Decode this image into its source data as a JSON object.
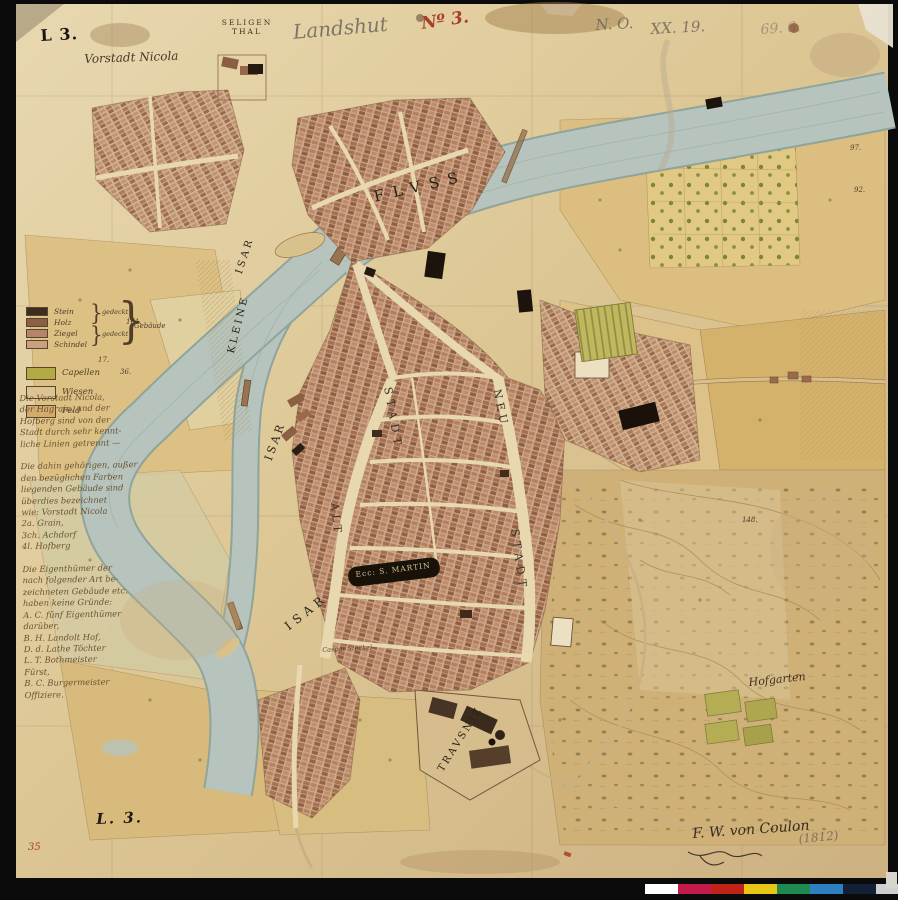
{
  "header": {
    "plate_mark": "L 3.",
    "title_pencil": "Landshut",
    "sheet_no_red": "Nº 3.",
    "pencil_note_1": "N. O.",
    "pencil_note_2": "XX. 19.",
    "pencil_note_3": "69. 6."
  },
  "map_labels": {
    "vorstadt_nicola": "Vorstadt Nicola",
    "seligenthal_line1": "SELIGEN",
    "seligenthal_line2": "THAL",
    "fluss": "FLVSS",
    "isar_upper": "ISAR",
    "kleine": "KLEINE",
    "isar_mid": "ISAR",
    "isar_lower": "ISAR",
    "stadt_left": "STADT",
    "alt": "ALT",
    "neu": "NEU",
    "stadt_right": "STADT",
    "st_martin": "Ecc: S. MARTIN",
    "trausnitz": "TRAVSNIZ",
    "hofgarten": "Hofgarten",
    "caspar_note": "Caspar Steckel"
  },
  "legend": {
    "building_rows": [
      {
        "label": "Stein",
        "color": "#3b2e20"
      },
      {
        "label": "Holz",
        "color": "#8a6147"
      },
      {
        "label": "Ziegel",
        "color": "#b5846a"
      },
      {
        "label": "Schindel",
        "color": "#caa17f"
      }
    ],
    "gedeckt_upper": "gedeckt",
    "gedeckt_lower": "gedeckt",
    "bracket_label": "Gebäude",
    "area_rows": [
      {
        "label": "Capellen",
        "color": "#b1aa45"
      },
      {
        "label": "Wiesen",
        "color": "#dcc492"
      },
      {
        "label": "Feld",
        "color": "#d2ab6d"
      }
    ]
  },
  "notes": {
    "lines": [
      "Die Vorstadt Nicola,",
      "der Hagrain, und der",
      "Hofberg sind von der",
      "Stadt durch sehr kennt-",
      "liche Linien getrennt —",
      "",
      "Die dahin gehörigen, außer",
      "den bezüglichen Farben",
      "liegenden Gebäude sind",
      "überdies bezeichnet",
      "wie: Vorstadt Nicola",
      "2a. Grain,",
      "3ch. Achdorf",
      "4l. Hofberg",
      "",
      "Die Eigenthümer der",
      "nach folgender Art be-",
      "zeichneten Gebäude etc.",
      "haben keine Gründe:",
      "A. C. fünf Eigenthümer",
      "darüber,",
      "B. H. Landolt Hof,",
      "D. d. Lathe Töchter",
      "L. T. Bothmeister",
      "      Fürst,",
      "B. C. Burgermeister",
      "      Offiziere."
    ]
  },
  "parcels": [
    "161.",
    "36.",
    "17.",
    "97.",
    "92.",
    "148."
  ],
  "footer": {
    "plate_mark": "L. 3.",
    "inventory_red": "35",
    "signature": "F. W. von Coulon",
    "date_pencil": "(1812)"
  },
  "colorbar": [
    "#ffffff",
    "#c21a4b",
    "#c02418",
    "#e8c614",
    "#1e8a52",
    "#2f80c0",
    "#142038",
    "#cfcfcf"
  ]
}
